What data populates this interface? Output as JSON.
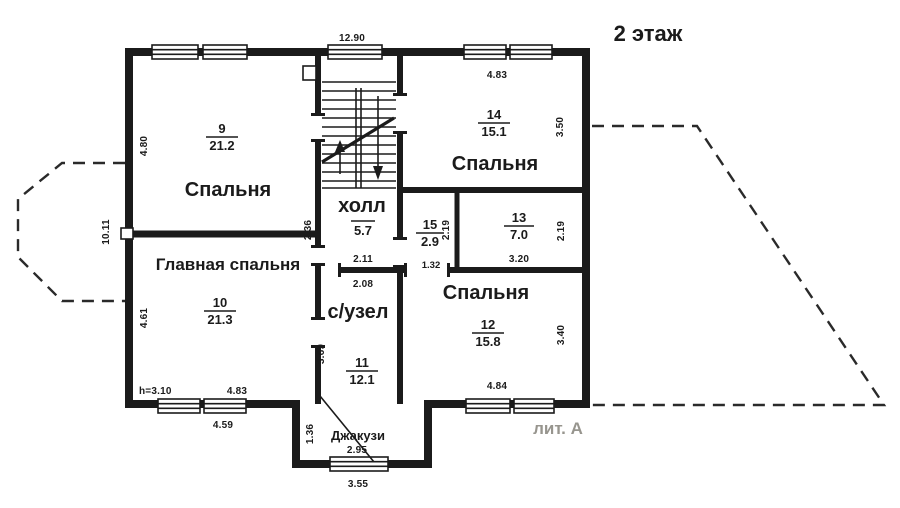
{
  "floor": {
    "title": "2 этаж",
    "litera": "лит. А"
  },
  "rooms": {
    "r9": {
      "num": "9",
      "area": "21.2",
      "label": "Спальня"
    },
    "r10": {
      "num": "10",
      "area": "21.3",
      "label": "Главная спальня"
    },
    "r11": {
      "num": "11",
      "area": "12.1",
      "label": "с/узел"
    },
    "r12": {
      "num": "12",
      "area": "15.8",
      "label": "Спальня"
    },
    "r13": {
      "num": "13",
      "area": "7.0"
    },
    "r14": {
      "num": "14",
      "area": "15.1",
      "label": "Спальня"
    },
    "r15": {
      "num": "15",
      "area": "2.9"
    },
    "hall": {
      "area": "5.7",
      "label": "холл"
    },
    "jacuzzi": {
      "label": "Джакузи"
    }
  },
  "dimensions": {
    "building_width_top": "12.90",
    "building_height_left": "10.11",
    "r9_left": "4.80",
    "r10_left": "4.61",
    "r10_bottom": "4.83",
    "r10_bottom_outer": "4.59",
    "ceiling_height": "h=3.10",
    "hall_left": "2.36",
    "hall_bottom": "2.11",
    "wc_top": "2.08",
    "wc_left": "3.69",
    "jacuzzi_left": "1.36",
    "jacuzzi_width": "2.95",
    "jacuzzi_bottom_outer": "3.55",
    "r14_top": "4.83",
    "r14_right": "3.50",
    "r15_right": "2.19",
    "r15_bottom": "1.32",
    "r13_bottom": "3.20",
    "r13_right": "2.19",
    "r12_bottom": "4.84",
    "r12_right": "3.40"
  }
}
